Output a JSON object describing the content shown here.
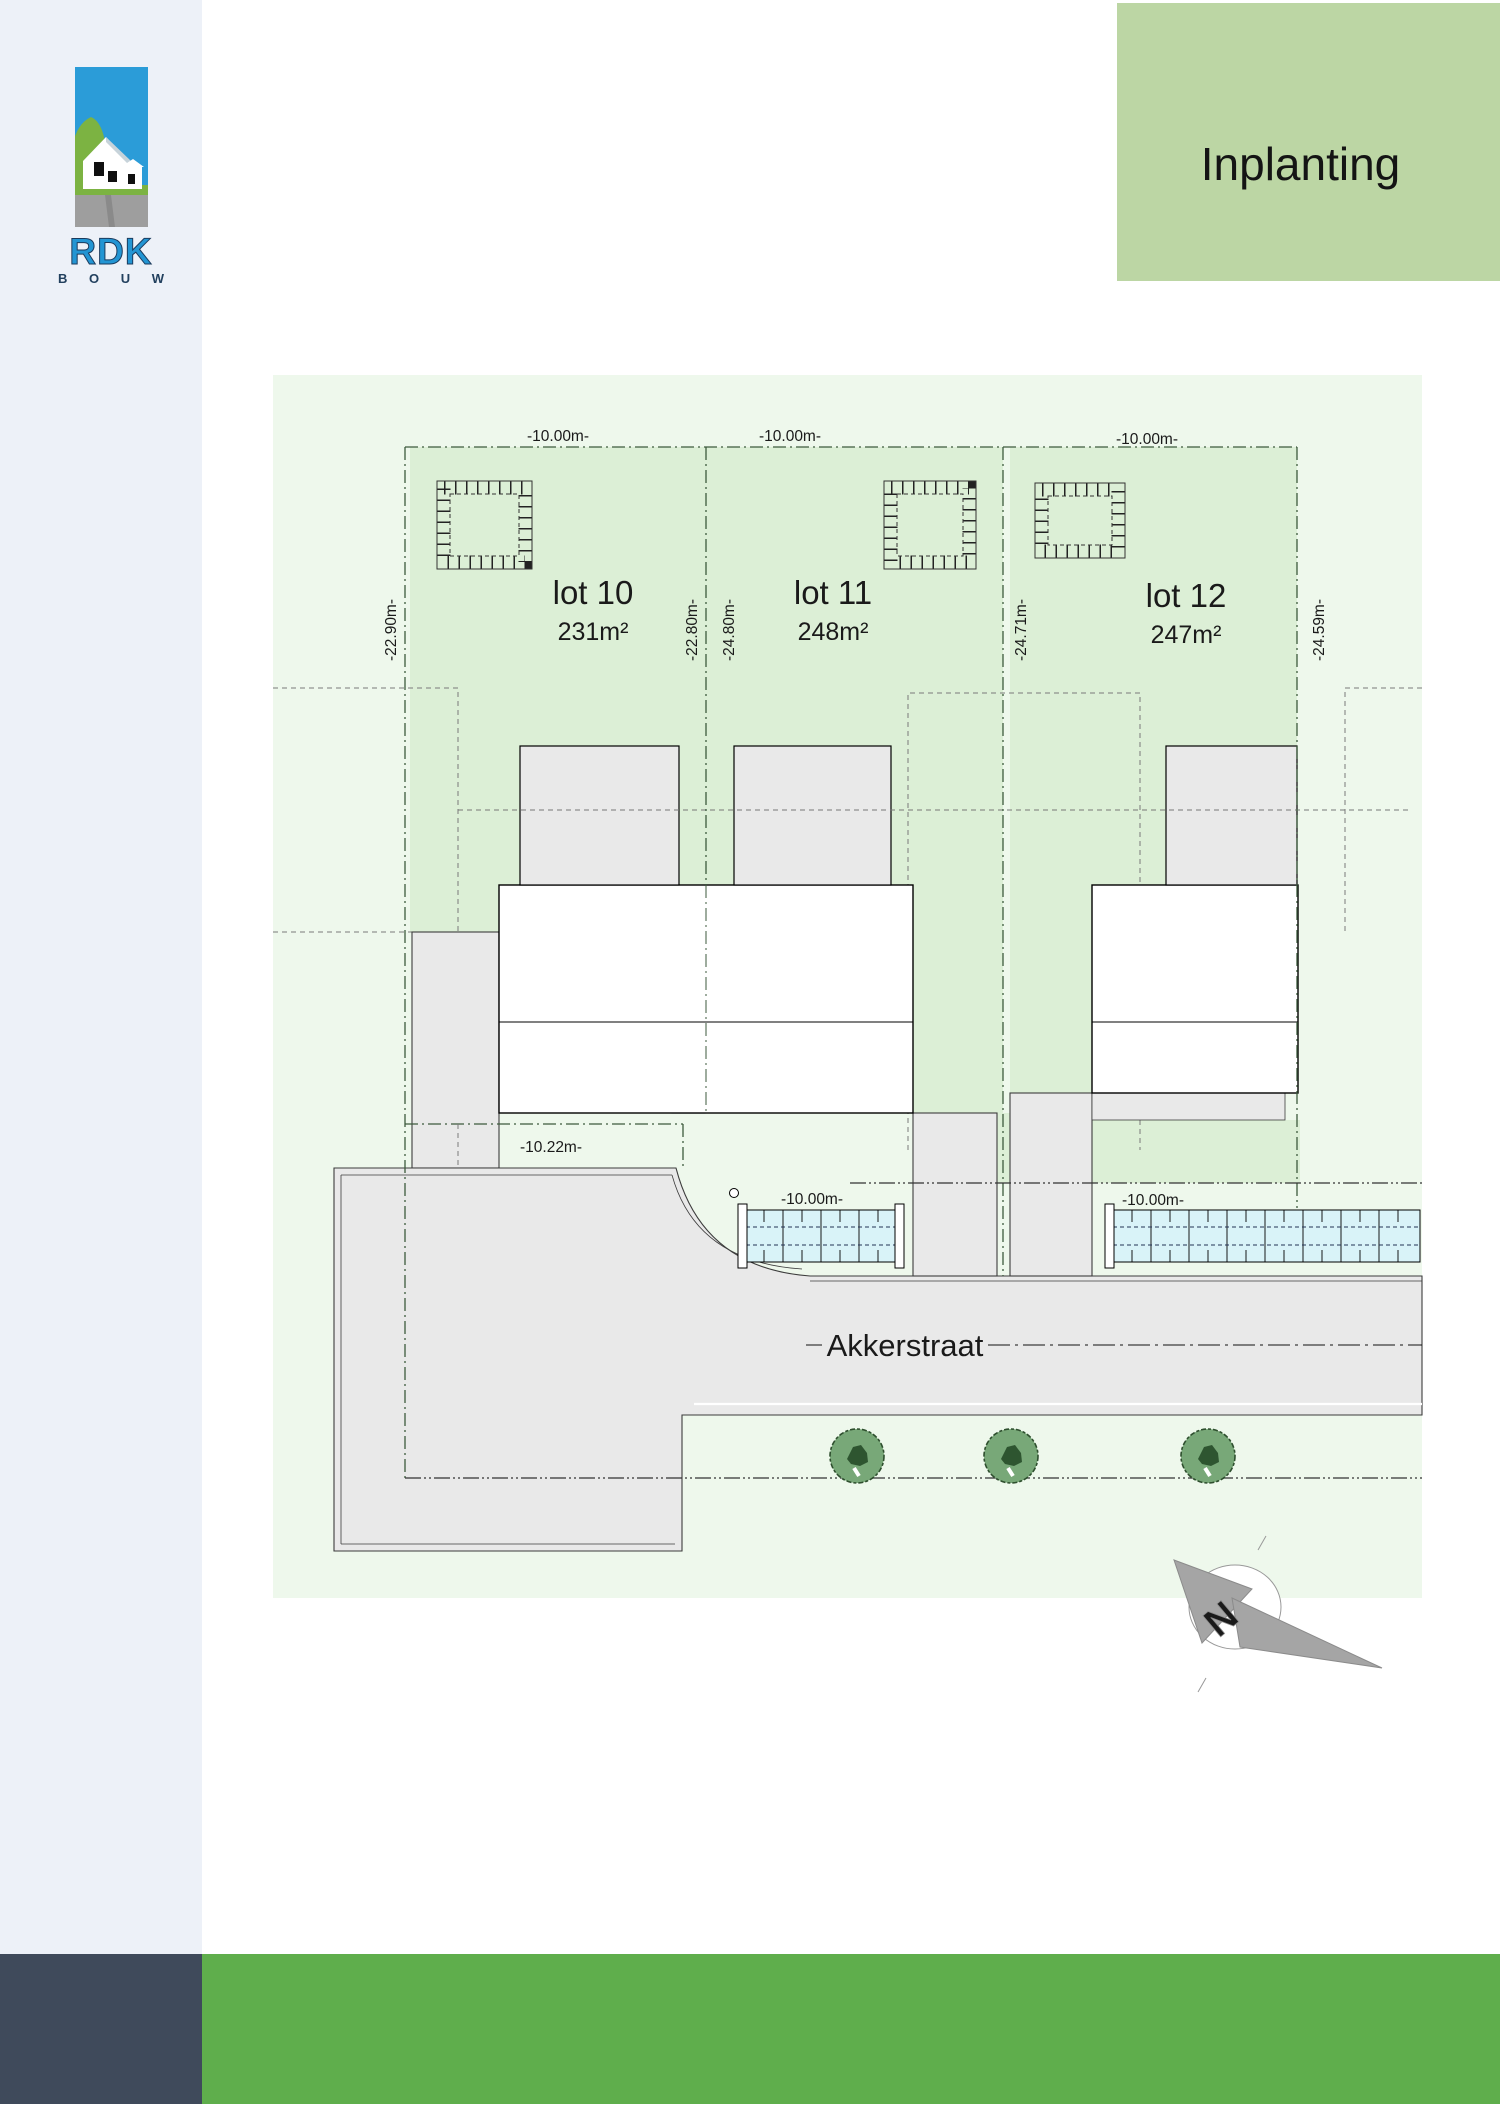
{
  "header": {
    "title": "Inplanting"
  },
  "logo": {
    "brand": "RDK",
    "sub": "B O U W"
  },
  "plan": {
    "street_name": "Akkerstraat",
    "compass_letter": "N",
    "lots": [
      {
        "name": "lot 10",
        "area": "231m²",
        "width_label": "-10.00m-"
      },
      {
        "name": "lot 11",
        "area": "248m²",
        "width_label": "-10.00m-"
      },
      {
        "name": "lot 12",
        "area": "247m²",
        "width_label": "-10.00m-"
      }
    ],
    "side_dimensions": {
      "left": "-22.90m-",
      "mid_left": "-22.80m-",
      "mid_right": "-24.80m-",
      "right_pair": "-24.71m-",
      "far_right": "-24.59m-"
    },
    "front_dimensions": {
      "lot10": "-10.22m-",
      "lot11": "-10.00m-",
      "lot12": "-10.00m-"
    }
  },
  "colors": {
    "header_green": "#bcd6a4",
    "footer_green": "#5fae4c",
    "footer_dark": "#3f4a5b",
    "sidebar": "#edf1f8",
    "plan_background": "#eef8ec",
    "lot_green": "#dcefd6",
    "paving_gray": "#e9e9e9",
    "hedge_blue": "#d9f3f8",
    "tree_green": "#78a878",
    "logo_blue": "#2b9cd8",
    "logo_green": "#7cb342"
  }
}
